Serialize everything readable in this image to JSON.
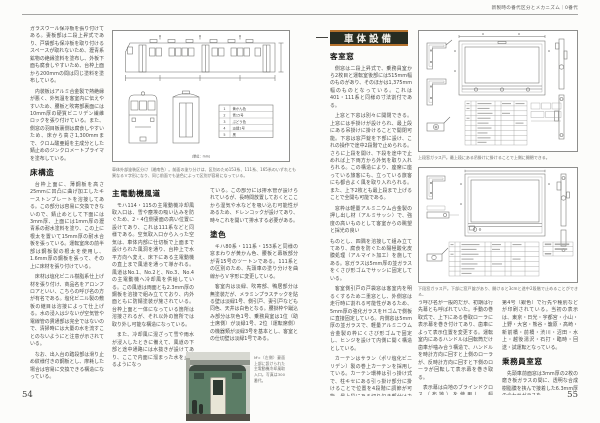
{
  "meta": {
    "header_right": "新製時の番代区分とメカニズム｜0番代",
    "page_left": "54",
    "page_right": "55"
  },
  "colors": {
    "section_box_bg": "#272c21",
    "section_box_rule_orange": "#b5732e",
    "photo_car_green": "#5c7d66"
  },
  "left_page": {
    "intro_p1": "ガラスウール保冷板を張り付けてある。妻板部は二段上昇式であり、戸袋部も保冷板を取り付けるスペースが取れないため、瀝青系鉱物の絶縁塗料を塗布し、外板下面も腐食しやすいため、台枠上面から200mmの間は同じ塗料を塗布している。",
    "intro_p2": "内装板はアルミ合金製で熱絶縁が悪く、外気温を客室内に伝えやすいため、腰板と吹寄部裏面には10mm厚の硬質ビニリデン繊維ロックを張り付けている。また、側窓の羽目板裏側は腐食しやすいため、床から高さ1,300mmまで、クロム酸亜鉛を主成分とした錆止めのジンクロメートプライマを塗布している。",
    "floor_heading": "床構造",
    "floor_p1": "台枠上面に、薄鋼板を高さ25mmに凹凸に曲げ加工したキーストンプレートを溶接してある。この部分は容易に交換できないので、錆止めとして下面には3mm厚、上面には1mm厚の瀝青系の耐水塗料を塗り、この上に根太を置いて15mm厚の耐水合板を張っている。運転室床の前半部は鋼板製の根太を使用し、1.6mm厚の鋼板を張って、その上に床材を張り付けている。",
    "floor_p2": "床材は塩化ビニル樹脂系仕上げ材を張り付け、商品名をアロンフロアといい、こちらの呼び名の方が有名である。塩化ビニル製の敷板の継目は溶接によって仕上げる。水の浸入は少ないが空気管や電線管の貫通部は完全ではないので、清掃時には大量の水を流すことのないようにと注意が示されている。",
    "floor_p3": "なお、出入台の踏段部は滑り止め紋様付きの鋼板とし、摩耗した場合は容易に交換できる構造になっている。",
    "diagram": {
      "caption": "車体外部塗装区分け（湘南色）。前面の塗り分けは、区別のため153系、111系、165系のいずれとも異なるＶ字形になり、同じ前面でも塗色によって区別が容易になっている。",
      "note": "（単位：mm）",
      "legend_nos": [
        "1",
        "2",
        "3",
        "4",
        "5"
      ],
      "legend_labels": [
        "黄かん色",
        "青15号",
        "ぶどう色",
        "淡緑1号",
        "黒"
      ]
    },
    "duct_heading": "主電動機風道",
    "duct_p1": "モハ114・115の主電動機冷却風取入口は、雪や塵埃の吸い込みを防ぐため、2・4位側妻面の高い位置に設けてあり、これは111系などと同様である。空気取入口から入った空気は、車体内部に仕切板で上面まで設けられた風洞を通り、台枠上で水平方向へ変え、床下にある主電動機の直上まで風道を通って導かれる。風道はNo.1、No.2と、No.3、No.4の主電動機へ冷却風を供給している。この風道は両面とも2.3mm厚の鋼板を溶接で組み立てており、内外面ともに防錆塗装が施されている。台枠上面と一体になっている箇所は溶接されるが、それ以外の箇所では取り外し可能な構造になっている。",
    "duct_p2": "また、冷却風に混ざって雪や雨水が浸入したときに備えて、風道の下部と途中通路には水抜きが設けてあり、ここで内面に溜まった水を止めるようになっ",
    "paint_cont": "ている。この部分には排水管が設けられているが、長時間放置しておくとここから湿気や水などを吸い込む可能性があるため、ドレンコックが設けてあり、時々これを開いて排水する必要がある。",
    "paint_heading": "塗色",
    "paint_p1": "キハ80系・111系・153系と同様の窓まわりが黄かん色、腰板と幕板部分が青15号のツートンである。111系との区別のため、先頭車の塗り分けを曲線からＶ字形に変更している。",
    "paint_p2": "客室内は淡緑、吹寄部、鴨居部分は無塗装だが、メラミンプラスチックを貼る壁は淡緑1号、側引戸、妻引戸なども同色、天井は白色となる。腰掛枠や蹴込み部分は灰色1号、乗務員室は1位（助士席側）が淡緑1号、2位（運転席側）の機器類が淡緑3号を基本とし、客室との仕切壁は淡緑1号である。",
    "photo_caption": "M'c（左側）妻面上部に設けられた主電動機冷却風取入口。写真は300番代。"
  },
  "right_page": {
    "box_label": "車体設備",
    "win_heading": "客室窓",
    "win_p1": "側窓は二段上昇式で、乗務員室から2枚目と運転室後部には515mm幅のものがあり、そのほかは1,375mm幅のものとなっている。これは401・111系と同様の寸法割付である。",
    "win_p2": "上窓と下窓は別々に開閉できる。上窓には手掛けが設けられ、最上段にある吊掛けに掛けることで開閉可能。下窓は窓戸錠を下部に設け、これの操作で途中2段階で止められる。さらに上段を開け、下段を途中で止めれば上下両方から外気を取り入れられる。この構造により、座席に座っている旅客にも、立っている旅客にも都合よく風を取り入れられる。また、上下2枚とも最上段まで上げることで全開も可能である。",
    "win_p3": "窓枠は軽量アルミニウム合金製の押し出し材（アルミサッシ）で、強度の高いものとして客室からの眺望と採光の良い",
    "win_p4": "ものとし、四隅を溶接して組み立ててあり、腐食を防ぐため陽極酸化皮膜処理（アルマイト加工）を施してある。窓ガラスは5mm厚の並ガラスをくさび形ゴムでサッシに固定している。",
    "win_p5": "客室側引戸の戸袋窓は客室内を明るくするため二重窓とし、外側窓は走行時に割れる可能性があるため、5mm厚の強化ガラスをＨゴムで側板に直接固定している。内側窓は5mm厚の並ガラスで、軽量アルミニウム合金製の枠にくさび形ゴムで固定し、ヒンジを設けて内側に開く構造としている。",
    "win_p6": "カーテンはサラン（ポリ塩化ビニリデン）製の巻上カーテンを採用している。カーテン環棒は引っ掛け式で、柱キセにある引っ掛け部分に掛けることで位置を4段階に調節が可能。最上段にある切り欠き部分はカーテンを交換するときに使用する。",
    "sign_heading": "前頭表示器",
    "sign_lead": "行先表示器、または種別表示器とい",
    "sign_p1": "う呼び名が一般的だが、初期は行先幕とも呼ばれていた。手動の巻取式で、上下にある巻取ローラに表示幕を巻き付けてあり、歯車によって表示位置を変更する。運転室内にあるハンドルは回転筒だけ歯車が噛み合う構造で、ハンドルを時計方向に回すと上側のローラが、反時計方向に回すと下側のローラが回転して表示幕を巻き取る。",
    "sign_p2": "表示幕は白地のブラインドクロス（布地）を使用し、幅660mm、長さ12mで、",
    "crew_cont": "第4号（銀色）で行先や種別などが印刷されている。当初の表示は、東京・日光・宇都宮・小山・上野・大宮・熊谷・籠原・高崎・新前橋・前橋・渋川・沼田・水上・越後湯沢・石打・臨時・回送・試運転となっている。",
    "crew_heading": "乗務員室窓",
    "crew_p1": "先頭車前面窓は3mm厚の2枚の磨き板ガラスの間に、透明な合成樹脂膜を挟んで接着した6.3mm厚の合わせガラスを",
    "cap1": "上段窓ガラス戸。最上段にある吊掛けに掛けることで上側に開閉できる。",
    "cap2": "下段窓ガラス戸。下部に窓戸錠があり、開けると3cmと途中2段階で止めることができる。"
  }
}
